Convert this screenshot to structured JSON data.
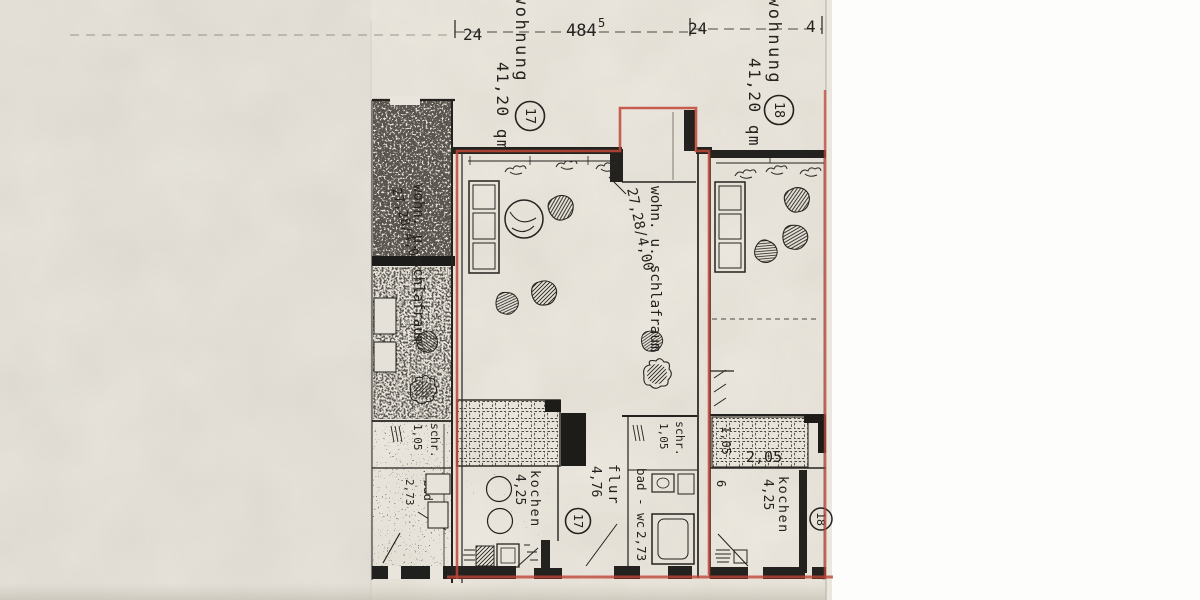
{
  "plan": {
    "colors": {
      "red": "#bf4537",
      "ink": "#24221e",
      "paper": "#ebe7de",
      "background_white": "#fdfdfb"
    },
    "dim_row": {
      "left": "24",
      "main": "484",
      "main_sup": "5",
      "right": "24",
      "far_right": "4"
    },
    "apt17": {
      "title": "wohnung",
      "area": "41,20 qm",
      "number": "17",
      "living_label": "wohn. u. schlafraum",
      "living_dim": "27,28/4,00",
      "kitchen_label": "kochen",
      "kitchen_dim": "4,25",
      "hall_label": "flur",
      "hall_dim": "4,76",
      "closet_label": "schr.",
      "closet_dim": "1,05",
      "bath_label": "bad - wc",
      "bath_dim": "2,73",
      "floor_number": "17"
    },
    "apt18": {
      "title": "wohnung",
      "area": "41,20 qm",
      "number": "18",
      "kitchen_label": "kochen",
      "kitchen_dim": "4,25",
      "dim_a": "1,05",
      "dim_b": "2,05",
      "dim_c": "6",
      "floor_number": "18"
    },
    "apt_left": {
      "living_label": "wohn. u. schlafraum",
      "living_dim": "27,28/4,00",
      "closet_label": "schr.",
      "closet_dim": "1,05",
      "bath_label": "bad",
      "bath_label2": "wc",
      "bath_dim": "2,73"
    }
  }
}
